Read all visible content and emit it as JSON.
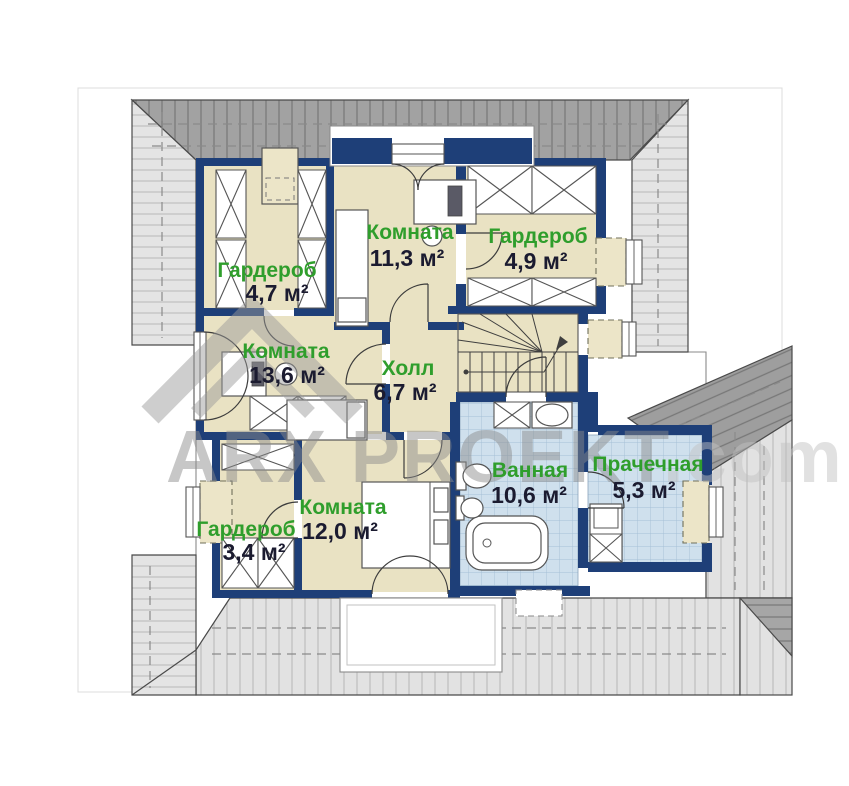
{
  "watermark": {
    "brand": "ARX PROEKT",
    "domain": ".com"
  },
  "rooms": [
    {
      "id": "garderob-top-left",
      "name": "Гардероб",
      "area": "4,7 м²"
    },
    {
      "id": "komnata-top",
      "name": "Комната",
      "area": "11,3 м²"
    },
    {
      "id": "garderob-top-right",
      "name": "Гардероб",
      "area": "4,9 м²"
    },
    {
      "id": "komnata-left",
      "name": "Комната",
      "area": "13,6 м²"
    },
    {
      "id": "holl",
      "name": "Холл",
      "area": "6,7 м²"
    },
    {
      "id": "komnata-bottom",
      "name": "Комната",
      "area": "12,0 м²"
    },
    {
      "id": "garderob-bottom-left",
      "name": "Гардероб",
      "area": "3,4 м²"
    },
    {
      "id": "vannaya",
      "name": "Ванная",
      "area": "10,6 м²"
    },
    {
      "id": "prachechnaya",
      "name": "Прачечная",
      "area": "5,3 м²"
    }
  ],
  "colors": {
    "wall": "#1e3f78",
    "room_fill": "#e9e2c3",
    "tile_fill": "#cfe0ed",
    "roof_dark": "#a2a2a2",
    "roof_light": "#e2e2e2",
    "label_green": "#2f9e2c",
    "label_dark": "#1b1b30",
    "watermark_gray": "#8c8c8c"
  }
}
